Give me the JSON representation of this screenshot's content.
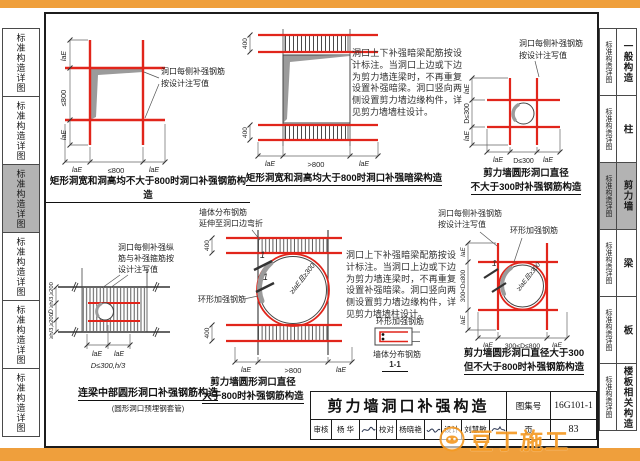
{
  "tabs": {
    "side_label": "标准构造详图",
    "right": [
      {
        "label": "一般构造",
        "active": false
      },
      {
        "label": "柱",
        "active": false
      },
      {
        "label": "剪力墙",
        "active": true
      },
      {
        "label": "梁",
        "active": false
      },
      {
        "label": "板",
        "active": false
      },
      {
        "label": "楼板相关构造",
        "active": false
      }
    ]
  },
  "dims": {
    "lae": "laE",
    "le800": "≤800",
    "gt800": ">800",
    "h400": "400",
    "d300": "D≤300",
    "d300_800": "300<D≤800",
    "hd": "≥h/3,≥200",
    "d": "D",
    "d4open": "D≤300,h/3",
    "ringlap": "≥laE且≥300",
    "mark1": "1"
  },
  "notes": {
    "side1": "洞口每侧补强钢筋",
    "side2": "按设计注写值",
    "beam1": "洞口每侧补强纵",
    "beam2": "筋与补强箍筋按",
    "beam3": "设计注写值",
    "walldist1": "墙体分布钢筋",
    "walldist2": "延伸至洞口边弯折",
    "ringbar": "环形加强钢筋",
    "walldist": "墙体分布钢筋",
    "section11": "1-1",
    "paragraph": "洞口上下补强暗梁配筋按设计标注。当洞口上边或下边为剪力墙连梁时，不再重复设置补强暗梁。洞口竖向两侧设置剪力墙边缘构件，详见剪力墙墙柱设计。"
  },
  "captions": {
    "d1": "矩形洞宽和洞高均不大于800时洞口补强钢筋构造",
    "d2": "矩形洞宽和洞高均大于800时洞口补强暗梁构造",
    "d3a": "剪力墙圆形洞口直径",
    "d3b": "不大于300时补强钢筋构造",
    "d4": "连梁中部圆形洞口补强钢筋构造",
    "d4sub": "(圆形洞口预埋钢套管)",
    "d5a": "剪力墙圆形洞口直径",
    "d5b": "大于800时补强钢筋构造",
    "d6a": "剪力墙圆形洞口直径大于300",
    "d6b": "但不大于800时补强钢筋构造"
  },
  "titleblock": {
    "title": "剪力墙洞口补强构造",
    "atlas_label": "图集号",
    "atlas_no": "16G101-1",
    "page_label": "页",
    "page_no": "83",
    "review_label": "审核",
    "review_name": "杨 华",
    "check_label": "校对",
    "check_name": "杨晓艳",
    "design_label": "设计",
    "design_name": "刘慧敏"
  },
  "watermark": {
    "text": "豆丁施工"
  }
}
